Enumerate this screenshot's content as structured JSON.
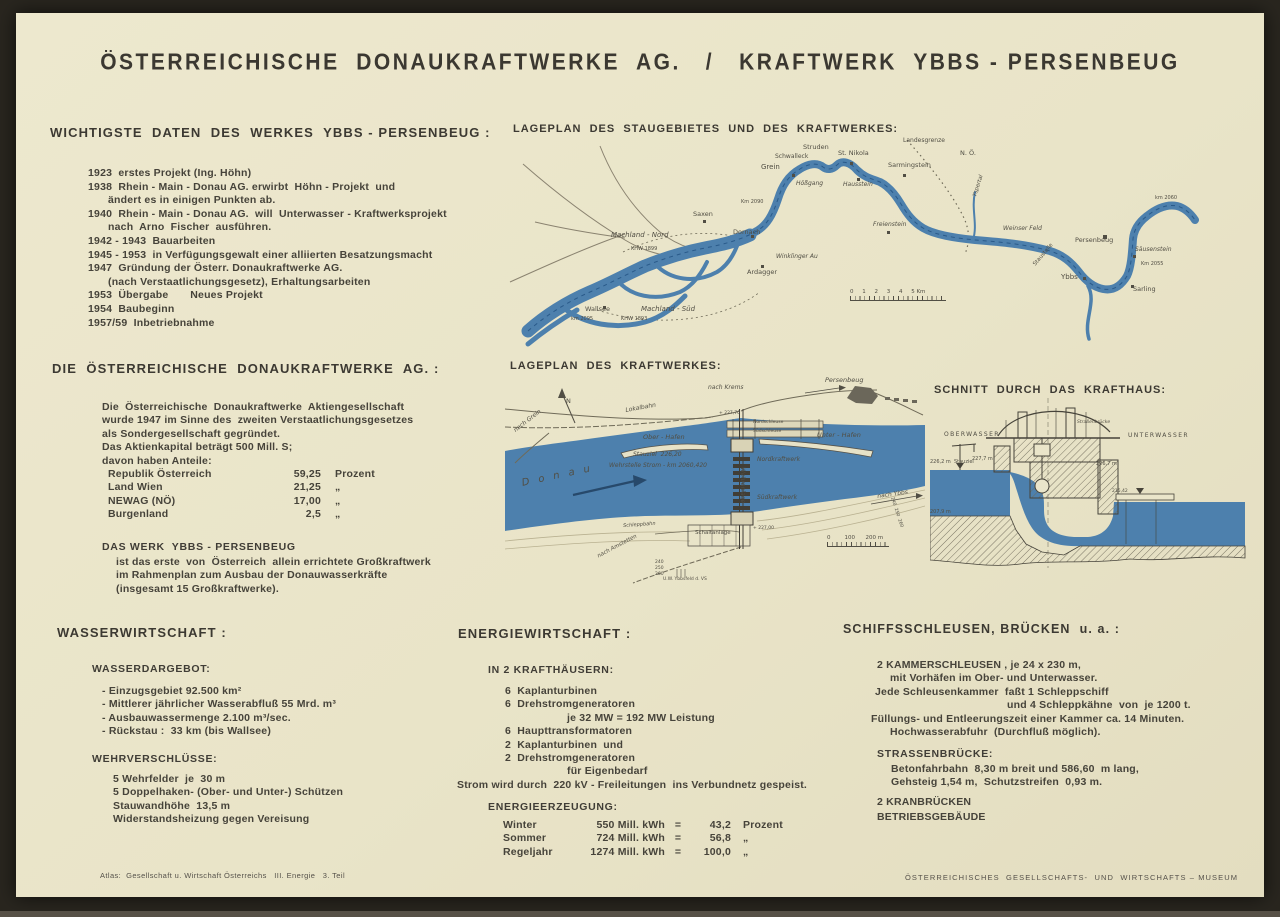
{
  "colors": {
    "paper": "#e9e4c8",
    "ink": "#46433a",
    "river": "#4d80ad",
    "frame": "#29261f"
  },
  "title": "ÖSTERREICHISCHE  DONAUKRAFTWERKE  AG.   /   KRAFTWERK  YBBS - PERSENBEUG",
  "daten": {
    "heading": "WICHTIGSTE  DATEN  DES  WERKES  YBBS - PERSENBEUG :",
    "lines": [
      {
        "t": "1923  erstes Projekt (Ing. Höhn)"
      },
      {
        "t": "1938  Rhein - Main - Donau AG. erwirbt  Höhn - Projekt  und"
      },
      {
        "t": "ändert es in einigen Punkten ab.",
        "cls": "wrap"
      },
      {
        "t": "1940  Rhein - Main - Donau AG.  will  Unterwasser - Kraftwerksprojekt"
      },
      {
        "t": "nach  Arno  Fischer  ausführen.",
        "cls": "wrap"
      },
      {
        "t": "1942 - 1943  Bauarbeiten"
      },
      {
        "t": "1945 - 1953  in Verfügungsgewalt einer alliierten Besatzungsmacht"
      },
      {
        "t": "1947  Gründung der Österr. Donaukraftwerke AG."
      },
      {
        "t": "(nach Verstaatlichungsgesetz), Erhaltungsarbeiten",
        "cls": "wrap"
      },
      {
        "t": "1953  Übergabe       Neues Projekt"
      },
      {
        "t": "1954  Baubeginn"
      },
      {
        "t": "1957/59  Inbetriebnahme"
      }
    ]
  },
  "dkw": {
    "heading": "DIE  ÖSTERREICHISCHE  DONAUKRAFTWERKE  AG. :",
    "para": [
      "Die  Österreichische  Donaukraftwerke  Aktiengesellschaft",
      "wurde 1947 im Sinne des  zweiten Verstaatlichungsgesetzes",
      "als Sondergesellschaft gegründet.",
      "Das Aktienkapital beträgt 500 Mill. S;",
      "davon haben Anteile:"
    ],
    "shares": [
      {
        "n": "Republik Österreich",
        "v": "59,25",
        "u": "Prozent"
      },
      {
        "n": "Land Wien",
        "v": "21,25",
        "u": "„"
      },
      {
        "n": "NEWAG (NÖ)",
        "v": "17,00",
        "u": "„"
      },
      {
        "n": "Burgenland",
        "v": "2,5",
        "u": "„"
      }
    ],
    "werk_title": "DAS WERK  YBBS - PERSENBEUG",
    "werk_lines": [
      "ist das erste  von  Österreich  allein errichtete Großkraftwerk",
      "im Rahmenplan zum Ausbau der Donauwasserkräfte",
      "(insgesamt 15 Großkraftwerke)."
    ]
  },
  "wasser": {
    "heading": "WASSERWIRTSCHAFT :",
    "sub1": "WASSERDARGEBOT:",
    "items1": [
      "- Einzugsgebiet 92.500 km²",
      "- Mittlerer jährlicher Wasserabfluß 55 Mrd. m³",
      "- Ausbauwassermenge 2.100 m³/sec.",
      "- Rückstau :  33 km (bis Wallsee)"
    ],
    "sub2": "WEHRVERSCHLÜSSE:",
    "items2": [
      "5 Wehrfelder  je  30 m",
      "5 Doppelhaken- (Ober- und Unter-) Schützen",
      "Stauwandhöhe  13,5 m",
      "Widerstandsheizung gegen Vereisung"
    ]
  },
  "energie": {
    "heading": "ENERGIEWIRTSCHAFT :",
    "sub1": "IN 2 KRAFTHÄUSERN:",
    "items": [
      {
        "t": "6  Kaplanturbinen"
      },
      {
        "t": "6  Drehstromgeneratoren"
      },
      {
        "t": "je 32 MW = 192 MW Leistung",
        "cls": "p62"
      },
      {
        "t": "6  Haupttransformatoren"
      },
      {
        "t": "2  Kaplanturbinen  und"
      },
      {
        "t": "2  Drehstromgeneratoren"
      },
      {
        "t": "für Eigenbedarf",
        "cls": "p62"
      }
    ],
    "strom": "Strom wird durch  220 kV - Freileitungen  ins Verbundnetz gespeist.",
    "sub2": "ENERGIEERZEUGUNG:",
    "table": [
      {
        "l": "Winter",
        "a": "550 Mill. kWh",
        "e": "=",
        "p": "43,2",
        "u": "Prozent"
      },
      {
        "l": "Sommer",
        "a": "724 Mill. kWh",
        "e": "=",
        "p": "56,8",
        "u": "„"
      },
      {
        "l": "Regeljahr",
        "a": "1274 Mill. kWh",
        "e": "=",
        "p": "100,0",
        "u": "„"
      }
    ]
  },
  "schleusen": {
    "heading": "SCHIFFSSCHLEUSEN, BRÜCKEN  u. a. :",
    "lines": [
      {
        "t": "2 KAMMERSCHLEUSEN , je 24 x 230 m,",
        "cls": "p16"
      },
      {
        "t": "mit Vorhäfen im Ober- und Unterwasser.",
        "cls": "p29"
      },
      {
        "t": "Jede Schleusenkammer  faßt 1 Schleppschiff",
        "cls": "p14"
      },
      {
        "t": "und 4 Schleppkähne  von  je 1200 t.",
        "cls": "p146"
      },
      {
        "t": "Füllungs- und Entleerungszeit einer Kammer ca. 14 Minuten.",
        "cls": "p10"
      },
      {
        "t": "Hochwasserabfuhr  (Durchfluß möglich).",
        "cls": "p29"
      }
    ],
    "sub": "STRASSENBRÜCKE:",
    "sub_lines": [
      {
        "t": "Betonfahrbahn  8,30 m breit und 586,60  m lang,",
        "cls": "p14"
      },
      {
        "t": "Gehsteig 1,54 m,  Schutzstreifen  0,93 m.",
        "cls": "p14"
      }
    ],
    "extra": [
      {
        "t": "2 KRANBRÜCKEN"
      },
      {
        "t": "BETRIEBSGEBÄUDE"
      }
    ]
  },
  "maps": {
    "a": {
      "heading": "LAGEPLAN  DES  STAUGEBIETES  UND  DES  KRAFTWERKES:",
      "scale": "0     1     2     3     4     5 Km",
      "labels": [
        {
          "t": "Landesgrenze",
          "x": 398,
          "y": 4,
          "fs": 6
        },
        {
          "t": "N. Ö.",
          "x": 455,
          "y": 16,
          "fs": 6.5
        },
        {
          "t": "Grein",
          "x": 256,
          "y": 30,
          "fs": 7
        },
        {
          "t": "Schwalleck",
          "x": 270,
          "y": 20,
          "fs": 6
        },
        {
          "t": "Struden",
          "x": 298,
          "y": 10,
          "fs": 6.5
        },
        {
          "t": "St. Nikola",
          "x": 333,
          "y": 16,
          "fs": 6.5
        },
        {
          "t": "Hößgang",
          "x": 291,
          "y": 47,
          "fs": 6,
          "cls": "it"
        },
        {
          "t": "Hausstein",
          "x": 338,
          "y": 48,
          "fs": 6,
          "cls": "it"
        },
        {
          "t": "Sarmingstein",
          "x": 383,
          "y": 28,
          "fs": 6.5
        },
        {
          "t": "Km 2090",
          "x": 236,
          "y": 66,
          "fs": 5
        },
        {
          "t": "Saxen",
          "x": 188,
          "y": 77,
          "fs": 6.5
        },
        {
          "t": "Dornach",
          "x": 228,
          "y": 95,
          "fs": 6.5
        },
        {
          "t": "Machland - Nord",
          "x": 106,
          "y": 98,
          "fs": 7,
          "cls": "it"
        },
        {
          "t": "KHW 1899",
          "x": 126,
          "y": 113,
          "fs": 5
        },
        {
          "t": "Winklinger Au",
          "x": 271,
          "y": 120,
          "fs": 6,
          "cls": "it"
        },
        {
          "t": "Ardagger",
          "x": 242,
          "y": 135,
          "fs": 6.5
        },
        {
          "t": "Freienstein",
          "x": 368,
          "y": 88,
          "fs": 6,
          "cls": "it"
        },
        {
          "t": "Weinser Feld",
          "x": 498,
          "y": 92,
          "fs": 6,
          "cls": "it"
        },
        {
          "t": "Yspertal",
          "x": 468,
          "y": 62,
          "fs": 5.5,
          "r": -72,
          "cls": "it"
        },
        {
          "t": "Persenbeug",
          "x": 570,
          "y": 103,
          "fs": 6.5
        },
        {
          "t": "km 2060",
          "x": 650,
          "y": 62,
          "fs": 5
        },
        {
          "t": "Säusenstein",
          "x": 630,
          "y": 113,
          "fs": 6,
          "cls": "it"
        },
        {
          "t": "Staustelle",
          "x": 528,
          "y": 130,
          "fs": 5.5,
          "r": -50
        },
        {
          "t": "Ybbs",
          "x": 556,
          "y": 140,
          "fs": 7
        },
        {
          "t": "Km 2055",
          "x": 636,
          "y": 128,
          "fs": 5
        },
        {
          "t": "Sarling",
          "x": 628,
          "y": 152,
          "fs": 6.5
        },
        {
          "t": "Wallsee",
          "x": 80,
          "y": 172,
          "fs": 6.5
        },
        {
          "t": "Machland - Süd",
          "x": 136,
          "y": 172,
          "fs": 7,
          "cls": "it"
        },
        {
          "t": "KHW 1893",
          "x": 116,
          "y": 183,
          "fs": 5
        },
        {
          "t": "km 2095",
          "x": 66,
          "y": 183,
          "fs": 5
        }
      ]
    },
    "b": {
      "heading": "LAGEPLAN  DES  KRAFTWERKES:",
      "scale": "0        100      200 m",
      "labels": [
        {
          "t": "nach Krems",
          "x": 203,
          "y": 14,
          "fs": 6,
          "cls": "it"
        },
        {
          "t": "Persenbeug",
          "x": 320,
          "y": 6,
          "fs": 6.5,
          "cls": "it"
        },
        {
          "t": "Lokalbahn",
          "x": 120,
          "y": 37,
          "fs": 6,
          "r": -10,
          "cls": "it"
        },
        {
          "t": "nach Grein",
          "x": 8,
          "y": 58,
          "fs": 6,
          "r": -38,
          "cls": "it"
        },
        {
          "t": "N",
          "x": 61,
          "y": 27,
          "fs": 6.5
        },
        {
          "t": "Ober - Hafen",
          "x": 138,
          "y": 63,
          "fs": 6.5,
          "cls": "it"
        },
        {
          "t": "Nordschleuse",
          "x": 248,
          "y": 50,
          "fs": 4.5
        },
        {
          "t": "Südschleuse",
          "x": 248,
          "y": 59,
          "fs": 4.5
        },
        {
          "t": "Unter - Hafen",
          "x": 312,
          "y": 61,
          "fs": 6.5,
          "cls": "it"
        },
        {
          "t": "+ 227,70",
          "x": 214,
          "y": 41,
          "fs": 4.5
        },
        {
          "t": "Nordkraftwerk",
          "x": 252,
          "y": 86,
          "fs": 6,
          "cls": "it"
        },
        {
          "t": "Stauziel  226,20",
          "x": 128,
          "y": 81,
          "fs": 6,
          "cls": "it"
        },
        {
          "t": "Wehrstelle Strom - km 2060,420",
          "x": 104,
          "y": 92,
          "fs": 6,
          "cls": "it"
        },
        {
          "t": "Wehranlage",
          "x": 240,
          "y": 96,
          "fs": 6,
          "r": 90,
          "cls": "it"
        },
        {
          "t": "Südkraftwerk",
          "x": 252,
          "y": 124,
          "fs": 6,
          "cls": "it"
        },
        {
          "t": "D o n a u",
          "x": 16,
          "y": 108,
          "fs": 10,
          "r": -12,
          "cls": "it big"
        },
        {
          "t": "nach Ybbs",
          "x": 372,
          "y": 123,
          "fs": 6,
          "r": -8,
          "cls": "it"
        },
        {
          "t": "Schleppbahn",
          "x": 118,
          "y": 153,
          "fs": 5,
          "r": -4,
          "cls": "it"
        },
        {
          "t": "Schaltanlage",
          "x": 190,
          "y": 160,
          "fs": 5.5
        },
        {
          "t": "+ 227,00",
          "x": 248,
          "y": 156,
          "fs": 4.5
        },
        {
          "t": "nach Amstetten",
          "x": 92,
          "y": 184,
          "fs": 5.5,
          "r": -28,
          "cls": "it"
        },
        {
          "t": "U.W. Ybbsfeld d. VS",
          "x": 158,
          "y": 207,
          "fs": 4.5
        },
        {
          "t": "240  250  260",
          "x": 388,
          "y": 126,
          "fs": 4.5,
          "r": 72
        },
        {
          "t": "240",
          "x": 150,
          "y": 190,
          "fs": 4.5
        },
        {
          "t": "250",
          "x": 150,
          "y": 196,
          "fs": 4.5
        },
        {
          "t": "260",
          "x": 150,
          "y": 202,
          "fs": 4.5
        }
      ]
    },
    "c": {
      "heading": "SCHNITT  DURCH  DAS  KRAFTHAUS:",
      "labels": [
        {
          "t": "OBERWASSER",
          "x": 14,
          "y": 38,
          "fs": 6,
          "cls": "sp"
        },
        {
          "t": "Straßenbrücke",
          "x": 147,
          "y": 27,
          "fs": 4.5,
          "cls": "it"
        },
        {
          "t": "UNTERWASSER",
          "x": 198,
          "y": 39,
          "fs": 6,
          "cls": "sp"
        },
        {
          "t": "226,2 m  Stauziel",
          "x": 0,
          "y": 66,
          "fs": 5
        },
        {
          "t": "227,7 m",
          "x": 42,
          "y": 63,
          "fs": 5
        },
        {
          "t": "226,7 m",
          "x": 166,
          "y": 68,
          "fs": 5
        },
        {
          "t": "215,42",
          "x": 182,
          "y": 96,
          "fs": 4.5
        },
        {
          "t": "207,9 m",
          "x": 0,
          "y": 116,
          "fs": 5
        }
      ]
    }
  },
  "footer": {
    "left": "Atlas:  Gesellschaft u. Wirtschaft Österreichs   III. Energie   3. Teil",
    "right": "ÖSTERREICHISCHES  GESELLSCHAFTS-  UND  WIRTSCHAFTS – MUSEUM"
  }
}
